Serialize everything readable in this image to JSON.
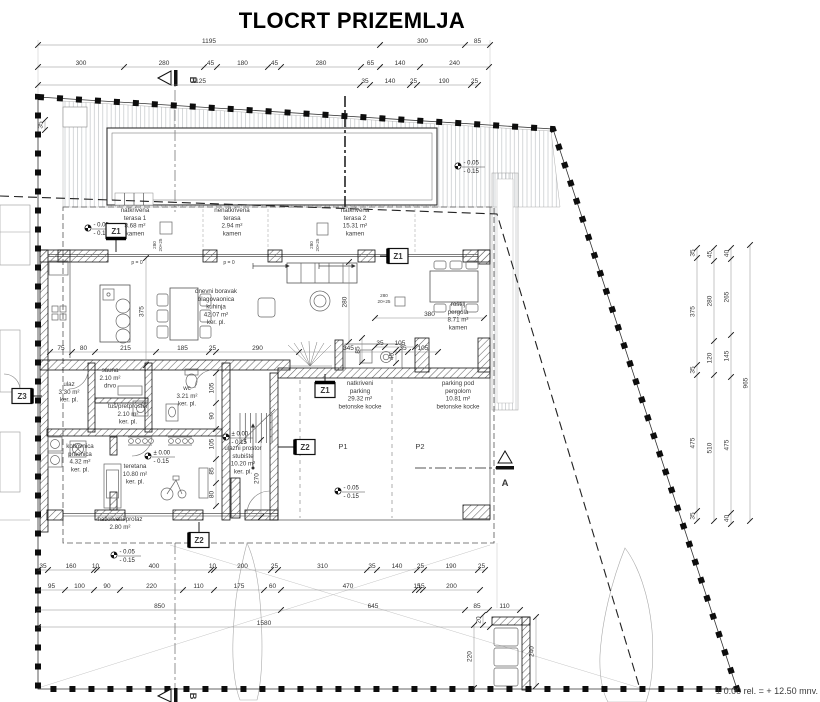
{
  "title": "TLOCRT PRIZEMLJA",
  "colors": {
    "ink": "#1a1a1a",
    "text": "#3a3a3a",
    "dim": "#444444"
  },
  "annotations": [
    {
      "x": 135,
      "y": 212,
      "t": [
        "natkrivena",
        "terasa 1",
        "8.68 m²",
        "kamen"
      ],
      "n": "room-label-terasa1"
    },
    {
      "x": 232,
      "y": 212,
      "t": [
        "nenatkrivena",
        "terasa",
        "2.94 m²",
        "kamen"
      ],
      "n": "room-label-terasa"
    },
    {
      "x": 355,
      "y": 212,
      "t": [
        "natkrivena",
        "terasa 2",
        "15.31 m²",
        "kamen"
      ],
      "n": "room-label-terasa2"
    },
    {
      "x": 216,
      "y": 293,
      "t": [
        "dnevni boravak",
        "blagovaonica",
        "kuhinja",
        "42.07 m²",
        "ker. pl."
      ],
      "n": "room-label-dnevni"
    },
    {
      "x": 458,
      "y": 306,
      "t": [
        "roštilj",
        "pergola",
        "8.71 m²",
        "kamen"
      ],
      "n": "room-label-pergola"
    },
    {
      "x": 360,
      "y": 385,
      "t": [
        "natkriveni",
        "parking",
        "29.32 m²",
        "betonske kocke"
      ],
      "n": "room-label-parking"
    },
    {
      "x": 458,
      "y": 385,
      "t": [
        "parking pod",
        "pergolom",
        "10.81 m²",
        "betonske kocke"
      ],
      "n": "room-label-parking2"
    },
    {
      "x": 110,
      "y": 372,
      "t": [
        "sauna",
        "2.10 m²",
        "drvo"
      ],
      "n": "room-label-sauna"
    },
    {
      "x": 69,
      "y": 386,
      "t": [
        "ulaz",
        "3.30 m²",
        "ker. pl."
      ],
      "n": "room-label-ulaz"
    },
    {
      "x": 128,
      "y": 408,
      "t": [
        "tuš/pretprostor",
        "2.10 m²",
        "ker. pl."
      ],
      "n": "room-label-tus"
    },
    {
      "x": 187,
      "y": 390,
      "t": [
        "wc",
        "3.21 m²",
        "ker. pl."
      ],
      "n": "room-label-wc"
    },
    {
      "x": 80,
      "y": 448,
      "t": [
        "kotlovnica",
        "praonica",
        "4.32 m²",
        "ker. pl."
      ],
      "n": "room-label-kotlovnica"
    },
    {
      "x": 135,
      "y": 468,
      "t": [
        "teretana",
        "10.80 m²",
        "ker. pl."
      ],
      "n": "room-label-teretana"
    },
    {
      "x": 243,
      "y": 450,
      "t": [
        "ulazni prostor",
        "stubište",
        "10.20 m²",
        "ker. pl."
      ],
      "n": "room-label-stubiste"
    },
    {
      "x": 120,
      "y": 521,
      "t": [
        "natkriveni prolaz",
        "2.80 m²"
      ],
      "n": "room-label-prolaz"
    },
    {
      "x": 343,
      "y": 449,
      "t": [
        "P1"
      ],
      "s": 7.5,
      "n": "parking-space-p1"
    },
    {
      "x": 420,
      "y": 449,
      "t": [
        "P2"
      ],
      "s": 7.5,
      "n": "parking-space-p2"
    },
    {
      "x": 137,
      "y": 264,
      "t": [
        "p = 0"
      ],
      "s": 5,
      "n": "slope-note"
    },
    {
      "x": 229,
      "y": 264,
      "t": [
        "p = 0"
      ],
      "s": 5,
      "n": "slope-note"
    },
    {
      "x": 156,
      "y": 245,
      "t": [
        "280",
        "20+25"
      ],
      "s": 4.6,
      "r": -90,
      "c": "#555",
      "n": "window-tag"
    },
    {
      "x": 313,
      "y": 245,
      "t": [
        "280",
        "20+25"
      ],
      "s": 4.6,
      "r": -90,
      "c": "#555",
      "n": "window-tag"
    },
    {
      "x": 384,
      "y": 297,
      "t": [
        "280",
        "20+25"
      ],
      "s": 4.6,
      "c": "#555",
      "n": "window-tag"
    },
    {
      "x": 818,
      "y": 694,
      "t": [
        "± 0.00 rel. = + 12.50 mnv."
      ],
      "s": 9,
      "an": "end",
      "c": "#111",
      "n": "datum-note"
    },
    {
      "x": 190,
      "y": 80,
      "t": [
        "B"
      ],
      "s": 9.5,
      "b": 1,
      "r": 90,
      "c": "#000",
      "n": "section-letter-b-top"
    },
    {
      "x": 190,
      "y": 696,
      "t": [
        "B"
      ],
      "s": 9.5,
      "b": 1,
      "r": 90,
      "c": "#000",
      "n": "section-letter-b-bottom"
    },
    {
      "x": 505,
      "y": 486,
      "t": [
        "A"
      ],
      "s": 9.5,
      "b": 1,
      "c": "#000",
      "n": "section-letter-a"
    }
  ],
  "dims": [
    {
      "o": "h",
      "pos": 45,
      "b": [
        38,
        380,
        465,
        490
      ],
      "lab": [
        "1195",
        "300",
        "85"
      ]
    },
    {
      "o": "h",
      "pos": 67,
      "b": [
        38,
        124,
        204,
        217,
        268,
        281,
        361,
        380,
        420,
        489
      ],
      "lab": [
        "300",
        "280",
        "45",
        "180",
        "45",
        "280",
        "65",
        "140",
        "240"
      ]
    },
    {
      "o": "h",
      "pos": 85,
      "b": [
        38,
        360,
        370,
        410,
        417,
        471,
        478
      ],
      "lab": [
        "1125",
        "35",
        "140",
        "25",
        "190",
        "25"
      ]
    },
    {
      "o": "h",
      "pos": 352,
      "b": [
        50,
        72,
        95,
        156,
        209,
        216,
        299,
        398,
        408,
        438
      ],
      "lab": [
        "75",
        "80",
        "215",
        "185",
        "25",
        "290",
        "345",
        "35",
        "105"
      ]
    },
    {
      "o": "h",
      "pos": 318,
      "b": [
        375,
        484
      ],
      "lab": [
        "380"
      ]
    },
    {
      "o": "h",
      "pos": 570,
      "b": [
        38,
        48,
        94,
        97,
        211,
        214,
        271,
        278,
        367,
        377,
        417,
        424,
        478,
        485
      ],
      "lab": [
        "35",
        "160",
        "10",
        "400",
        "10",
        "200",
        "25",
        "310",
        "35",
        "140",
        "25",
        "190",
        "25"
      ]
    },
    {
      "o": "h",
      "pos": 590,
      "b": [
        38,
        65,
        94,
        120,
        183,
        214,
        264,
        281,
        415,
        419,
        423,
        480
      ],
      "lab": [
        "95",
        "100",
        "90",
        "220",
        "110",
        "175",
        "60",
        "470",
        "15",
        "15",
        "200"
      ]
    },
    {
      "o": "h",
      "pos": 610,
      "b": [
        38,
        281,
        465,
        489,
        520
      ],
      "lab": [
        "850",
        "645",
        "85",
        "110"
      ]
    },
    {
      "o": "h",
      "pos": 627,
      "b": [
        38,
        490
      ],
      "lab": [
        "1580"
      ]
    },
    {
      "o": "v",
      "pos": 697,
      "b": [
        248,
        258,
        365,
        375,
        511,
        521
      ],
      "lab": [
        "35",
        "375",
        "35",
        "475",
        "35"
      ]
    },
    {
      "o": "v",
      "pos": 714,
      "b": [
        248,
        261,
        341,
        375,
        521
      ],
      "lab": [
        "45",
        "280",
        "120",
        "510"
      ]
    },
    {
      "o": "v",
      "pos": 731,
      "b": [
        248,
        259,
        335,
        377,
        513,
        524
      ],
      "lab": [
        "40",
        "265",
        "145",
        "475",
        "40"
      ]
    },
    {
      "o": "v",
      "pos": 750,
      "b": [
        245,
        521
      ],
      "lab": [
        "965"
      ]
    },
    {
      "o": "v",
      "pos": 146,
      "b": [
        258,
        365
      ],
      "lab": [
        "375"
      ]
    },
    {
      "o": "v",
      "pos": 349,
      "b": [
        262,
        342
      ],
      "lab": [
        "280"
      ]
    },
    {
      "o": "v",
      "pos": 261,
      "b": [
        440,
        517
      ],
      "lab": [
        "270"
      ]
    },
    {
      "o": "v",
      "pos": 216,
      "b": [
        373,
        403,
        429,
        459,
        483,
        506
      ],
      "lab": [
        "105",
        "90",
        "105",
        "85",
        "80"
      ]
    },
    {
      "o": "v",
      "pos": 536,
      "b": [
        617,
        686
      ],
      "lab": [
        "240"
      ]
    },
    {
      "o": "v",
      "pos": 474,
      "b": [
        625,
        688
      ],
      "lab": [
        "220"
      ]
    },
    {
      "o": "v",
      "pos": 483,
      "b": [
        615,
        625
      ],
      "lab": [
        "20"
      ]
    },
    {
      "o": "v",
      "pos": 45,
      "b": [
        120,
        130
      ],
      "lab": [
        "35"
      ]
    },
    {
      "o": "v",
      "pos": 362,
      "b": [
        338,
        362
      ],
      "lab": [
        "85"
      ]
    },
    {
      "o": "v",
      "pos": 396,
      "b": [
        350,
        363
      ],
      "lab": [
        "45"
      ]
    },
    {
      "o": "h",
      "pos": 347,
      "b": [
        375,
        385,
        415
      ],
      "lab": [
        "35",
        "105"
      ]
    }
  ],
  "levels": [
    {
      "x": 88,
      "y": 228,
      "t": [
        "- 0.05",
        "- 0.15"
      ]
    },
    {
      "x": 458,
      "y": 166,
      "t": [
        "- 0.05",
        "- 0.15"
      ]
    },
    {
      "x": 148,
      "y": 456,
      "t": [
        "± 0.00",
        "- 0.15"
      ]
    },
    {
      "x": 226,
      "y": 437,
      "t": [
        "± 0.00",
        "- 0.15"
      ]
    },
    {
      "x": 338,
      "y": 491,
      "t": [
        "- 0.05",
        "- 0.15"
      ]
    },
    {
      "x": 114,
      "y": 555,
      "t": [
        "- 0.05",
        "- 0.15"
      ]
    }
  ],
  "zmarks": [
    {
      "x": 116,
      "y": 231,
      "l": "Z1",
      "bar": "bottom",
      "ld": [
        116,
        252
      ]
    },
    {
      "x": 398,
      "y": 256,
      "l": "Z1",
      "bar": "left",
      "ld": [
        380,
        256
      ]
    },
    {
      "x": 325,
      "y": 390,
      "l": "Z1",
      "bar": "top",
      "ld": [
        325,
        374
      ]
    },
    {
      "x": 305,
      "y": 447,
      "l": "Z2",
      "bar": "left",
      "ld": [
        278,
        447
      ]
    },
    {
      "x": 199,
      "y": 540,
      "l": "Z2",
      "bar": "left",
      "ld": [
        199,
        522
      ]
    },
    {
      "x": 22,
      "y": 396,
      "l": "Z3",
      "bar": "right",
      "ld": [
        42,
        396
      ]
    }
  ]
}
